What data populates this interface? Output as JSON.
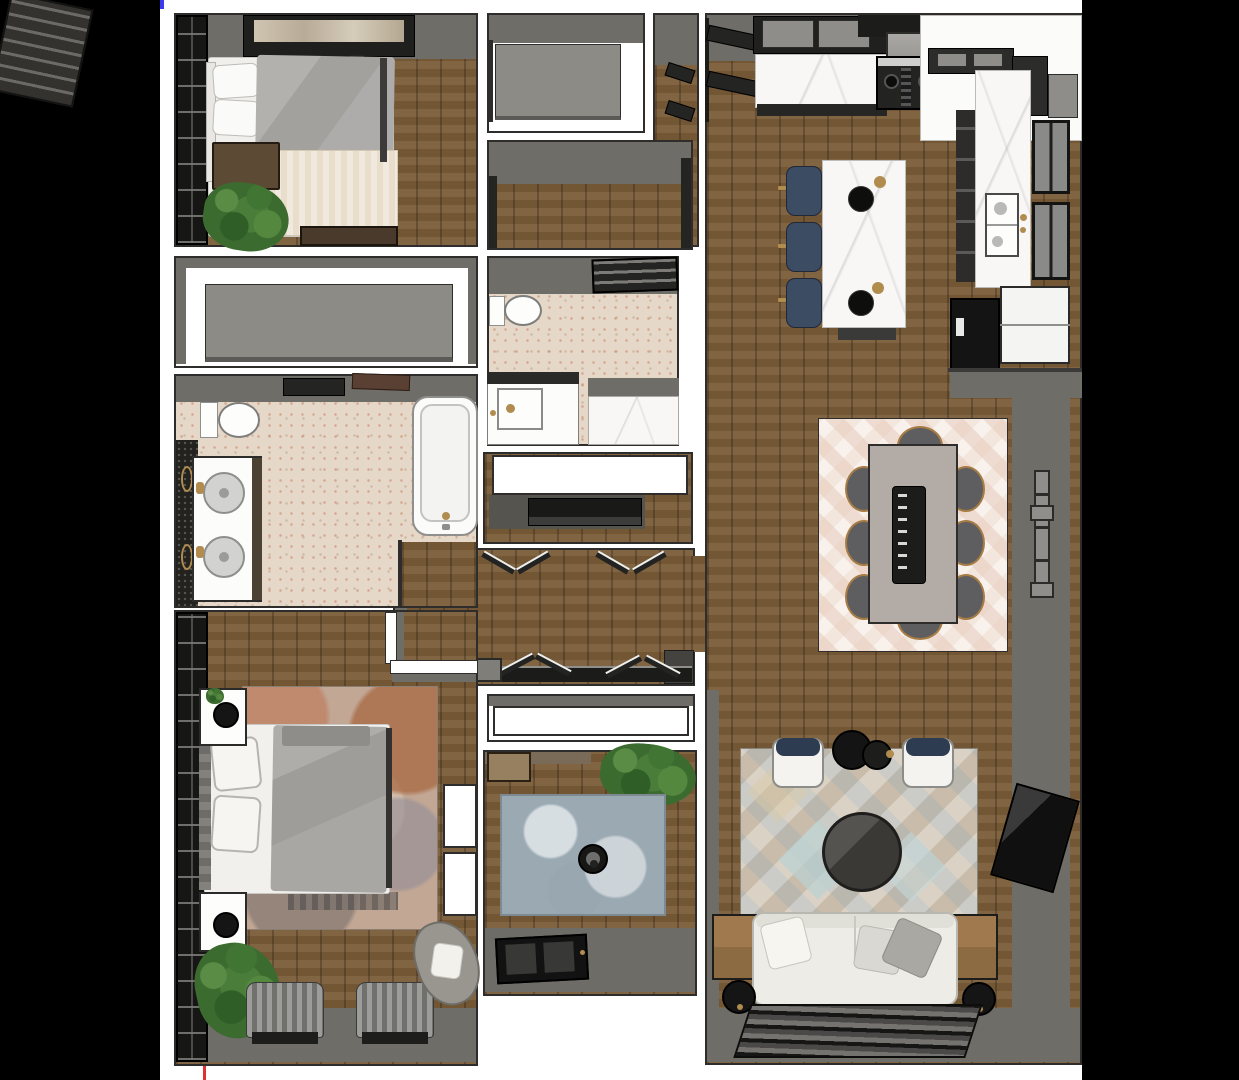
{
  "scene": {
    "kind": "3d-top-down-floor-plan-rendering",
    "background": "#000000",
    "canvas_background": "#ffffff",
    "marks": {
      "blue_corner_tick": "#3b3bf0",
      "green_edge_tick": "#3f9b4f",
      "red_bottom_tick": "#e03131"
    }
  },
  "palette": {
    "wall_gray": "#6f6d67",
    "wood_floor": "#7a5c38",
    "marble_white": "#f8f7f5",
    "cabinet_dark": "#242423",
    "navy": "#3c4c63",
    "tile_beige": "#e6d8c8",
    "rug_blue": "#a3b0b8",
    "rug_cream": "#f3e6dc",
    "rug_diamond": "#cfc6ba",
    "plant_green": "#4a7c3a",
    "sofa_white": "#edece6",
    "accent_gold": "#b08c4f"
  },
  "rooms": [
    {
      "name": "bedroom-1",
      "furniture": [
        "wardrobe",
        "wall-art",
        "bed",
        "pillows",
        "gray-duvet",
        "cream-throw",
        "nightstand",
        "plant",
        "foot-bench"
      ]
    },
    {
      "name": "closet-a",
      "furniture": [
        "shelf-panel"
      ]
    },
    {
      "name": "linen-nook",
      "furniture": [
        "wall-shelves"
      ]
    },
    {
      "name": "walk-in-closet",
      "furniture": []
    },
    {
      "name": "bathroom-2",
      "furniture": [
        "wall-shelf",
        "toilet",
        "vanity-sink",
        "walk-in-shower"
      ]
    },
    {
      "name": "utility-closet",
      "furniture": [
        "counter",
        "media-appliance"
      ]
    },
    {
      "name": "hallway",
      "furniture": [
        "double-doors-top",
        "double-doors-bottom",
        "threshold",
        "step"
      ]
    },
    {
      "name": "closet-b",
      "furniture": [
        "sliding-panel"
      ]
    },
    {
      "name": "bathroom-1",
      "furniture": [
        "towel-bar",
        "door-panel",
        "toilet",
        "double-vanity",
        "sinks",
        "bathtub",
        "tile-wall",
        "gold-sconces"
      ]
    },
    {
      "name": "master-bedroom",
      "furniture": [
        "wardrobe",
        "nightstand-1",
        "nightstand-2",
        "lamps",
        "bed",
        "pillows",
        "area-rug",
        "closet-doors",
        "plant",
        "pleated-benches",
        "accent-chair"
      ]
    },
    {
      "name": "kitchen",
      "furniture": [
        "pantry-shelves",
        "upper-cabinets",
        "range-hood",
        "stove",
        "marble-counters",
        "corner-cabinets",
        "sink",
        "windows",
        "refrigerator",
        "tall-cabinet",
        "island",
        "decor-bowls",
        "bar-stools"
      ]
    },
    {
      "name": "dining-area",
      "furniture": [
        "area-rug",
        "dining-table",
        "runner-tray",
        "chairs-8",
        "wall-shelf-bar"
      ]
    },
    {
      "name": "living-room",
      "furniture": [
        "diamond-rug",
        "accent-chairs",
        "round-side-table",
        "round-coffee-table",
        "sofa",
        "throw-pillows",
        "end-tables",
        "lamps",
        "tv",
        "media-console",
        "window-band"
      ]
    },
    {
      "name": "entry",
      "furniture": [
        "coat-closet-shelf",
        "console",
        "plant",
        "blue-rug",
        "round-stand",
        "front-door",
        "porch"
      ]
    }
  ]
}
